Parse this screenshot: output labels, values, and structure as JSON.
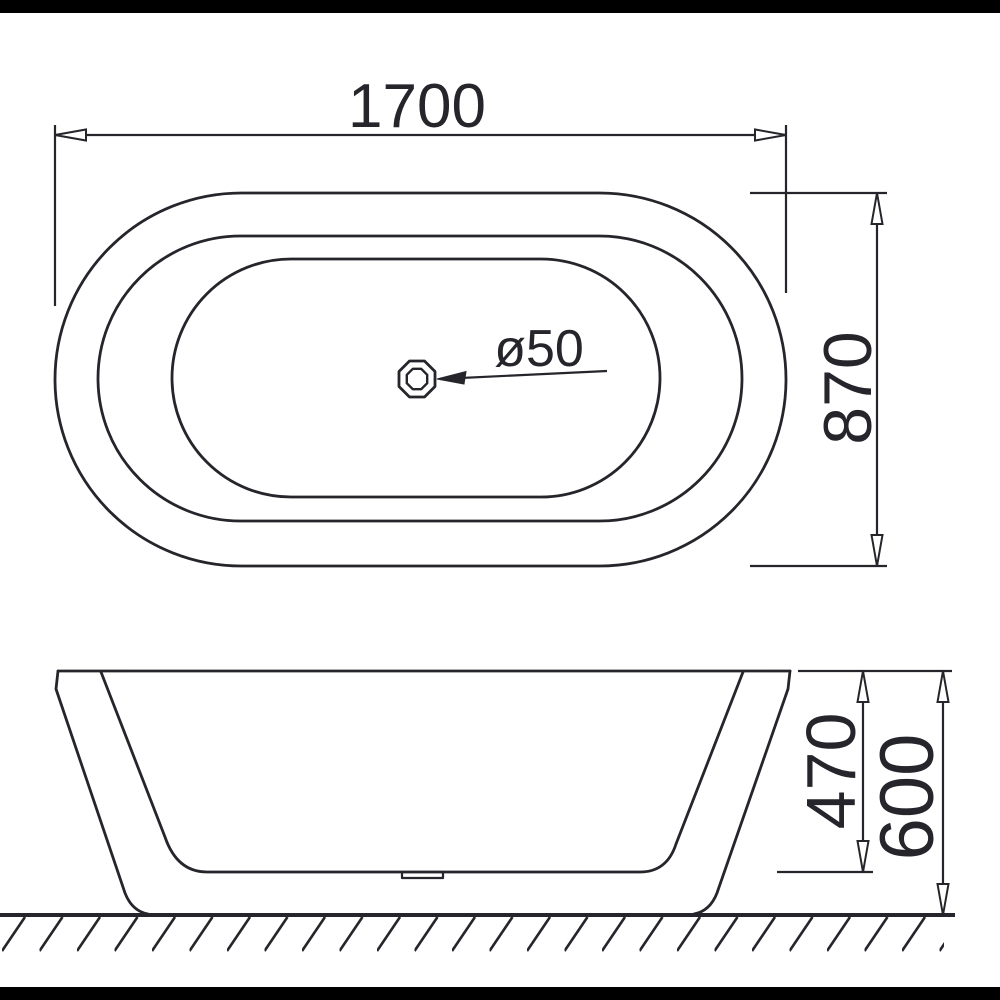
{
  "drawing": {
    "title": "Freestanding bathtub technical drawing",
    "views": {
      "plan": "top view",
      "elevation": "side view"
    },
    "labels": {
      "overall_length": "1700",
      "overall_width": "870",
      "drain_diameter": "ø50",
      "basin_depth": "470",
      "overall_height": "600"
    },
    "colors": {
      "line": "#25252b",
      "background": "#ffffff",
      "letterbox": "#000000"
    }
  }
}
